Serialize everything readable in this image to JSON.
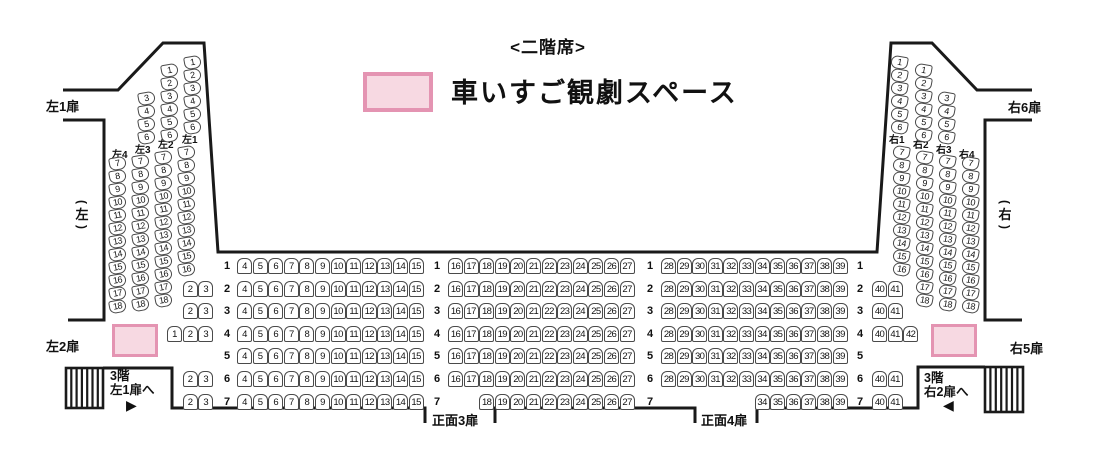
{
  "title": "<二階席>",
  "legend": {
    "label": "車いすご観劇スペース"
  },
  "colors": {
    "wheelchair_fill": "#f7d9e2",
    "wheelchair_border": "#e494b2",
    "wall": "#1a1a1a",
    "seat_border": "#4a4a4a"
  },
  "labels": {
    "door_left1": "左1扉",
    "door_left2": "左2扉",
    "door_right6": "右6扉",
    "door_right5": "右5扉",
    "door_front3": "正面3扉",
    "door_front4": "正面4扉",
    "side_left": "(左)",
    "side_right": "(右)"
  },
  "stairs": {
    "left": {
      "line1": "3階",
      "line2": "左1扉へ",
      "arrow": "▶"
    },
    "right": {
      "line1": "3階",
      "line2": "右2扉へ",
      "arrow": "◀"
    }
  },
  "wheelchair_spaces": [
    {
      "location": "left"
    },
    {
      "location": "right"
    }
  ],
  "left_columns": [
    {
      "label": "左4",
      "top_seats": [],
      "bottom_seats": [
        7,
        8,
        9,
        10,
        11,
        12,
        13,
        14,
        15,
        16,
        17,
        18
      ]
    },
    {
      "label": "左3",
      "top_seats": [
        3,
        4,
        5,
        6
      ],
      "bottom_seats": [
        7,
        8,
        9,
        10,
        11,
        12,
        13,
        14,
        15,
        16,
        17,
        18
      ]
    },
    {
      "label": "左2",
      "top_seats": [
        1,
        2,
        3,
        4,
        5,
        6
      ],
      "bottom_seats": [
        7,
        8,
        9,
        10,
        11,
        12,
        13,
        14,
        15,
        16,
        17,
        18
      ]
    },
    {
      "label": "左1",
      "top_seats": [
        1,
        2,
        3,
        4,
        5,
        6
      ],
      "bottom_seats": [
        7,
        8,
        9,
        10,
        11,
        12,
        13,
        14,
        15,
        16
      ]
    }
  ],
  "right_columns": [
    {
      "label": "右1",
      "top_seats": [
        1,
        2,
        3,
        4,
        5,
        6
      ],
      "bottom_seats": [
        7,
        8,
        9,
        10,
        11,
        12,
        13,
        14,
        15,
        16
      ]
    },
    {
      "label": "右2",
      "top_seats": [
        1,
        2,
        3,
        4,
        5,
        6
      ],
      "bottom_seats": [
        7,
        8,
        9,
        10,
        11,
        12,
        13,
        14,
        15,
        16,
        17,
        18
      ]
    },
    {
      "label": "右3",
      "top_seats": [
        3,
        4,
        5,
        6
      ],
      "bottom_seats": [
        7,
        8,
        9,
        10,
        11,
        12,
        13,
        14,
        15,
        16,
        17,
        18
      ]
    },
    {
      "label": "右4",
      "top_seats": [],
      "bottom_seats": [
        7,
        8,
        9,
        10,
        11,
        12,
        13,
        14,
        15,
        16,
        17,
        18
      ]
    }
  ],
  "center_rows": [
    {
      "row": "1",
      "left_small": [],
      "block_a": [
        4,
        5,
        6,
        7,
        8,
        9,
        10,
        11,
        12,
        13,
        14,
        15
      ],
      "block_b": [
        16,
        17,
        18,
        19,
        20,
        21,
        22,
        23,
        24,
        25,
        26,
        27
      ],
      "block_c": [
        28,
        29,
        30,
        31,
        32,
        33,
        34,
        35,
        36,
        37,
        38,
        39
      ],
      "right_small": []
    },
    {
      "row": "2",
      "left_small": [
        2,
        3
      ],
      "block_a": [
        4,
        5,
        6,
        7,
        8,
        9,
        10,
        11,
        12,
        13,
        14,
        15
      ],
      "block_b": [
        16,
        17,
        18,
        19,
        20,
        21,
        22,
        23,
        24,
        25,
        26,
        27
      ],
      "block_c": [
        28,
        29,
        30,
        31,
        32,
        33,
        34,
        35,
        36,
        37,
        38,
        39
      ],
      "right_small": [
        40,
        41
      ]
    },
    {
      "row": "3",
      "left_small": [
        2,
        3
      ],
      "block_a": [
        4,
        5,
        6,
        7,
        8,
        9,
        10,
        11,
        12,
        13,
        14,
        15
      ],
      "block_b": [
        16,
        17,
        18,
        19,
        20,
        21,
        22,
        23,
        24,
        25,
        26,
        27
      ],
      "block_c": [
        28,
        29,
        30,
        31,
        32,
        33,
        34,
        35,
        36,
        37,
        38,
        39
      ],
      "right_small": [
        40,
        41
      ]
    },
    {
      "row": "4",
      "left_small": [
        1,
        2,
        3
      ],
      "block_a": [
        4,
        5,
        6,
        7,
        8,
        9,
        10,
        11,
        12,
        13,
        14,
        15
      ],
      "block_b": [
        16,
        17,
        18,
        19,
        20,
        21,
        22,
        23,
        24,
        25,
        26,
        27
      ],
      "block_c": [
        28,
        29,
        30,
        31,
        32,
        33,
        34,
        35,
        36,
        37,
        38,
        39
      ],
      "right_small": [
        40,
        41,
        42
      ]
    },
    {
      "row": "5",
      "left_small": [],
      "block_a": [
        4,
        5,
        6,
        7,
        8,
        9,
        10,
        11,
        12,
        13,
        14,
        15
      ],
      "block_b": [
        16,
        17,
        18,
        19,
        20,
        21,
        22,
        23,
        24,
        25,
        26,
        27
      ],
      "block_c": [
        28,
        29,
        30,
        31,
        32,
        33,
        34,
        35,
        36,
        37,
        38,
        39
      ],
      "right_small": []
    },
    {
      "row": "6",
      "left_small": [
        2,
        3
      ],
      "block_a": [
        4,
        5,
        6,
        7,
        8,
        9,
        10,
        11,
        12,
        13,
        14,
        15
      ],
      "block_b": [
        16,
        17,
        18,
        19,
        20,
        21,
        22,
        23,
        24,
        25,
        26,
        27
      ],
      "block_c": [
        28,
        29,
        30,
        31,
        32,
        33,
        34,
        35,
        36,
        37,
        38,
        39
      ],
      "right_small": [
        40,
        41
      ]
    },
    {
      "row": "7",
      "left_small": [
        2,
        3
      ],
      "block_a": [
        4,
        5,
        6,
        7,
        8,
        9,
        10,
        11,
        12,
        13,
        14,
        15
      ],
      "block_b": [
        18,
        19,
        20,
        21,
        22,
        23,
        24,
        25,
        26,
        27
      ],
      "block_c": [
        34,
        35,
        36,
        37,
        38,
        39
      ],
      "right_small": [
        40,
        41
      ]
    }
  ]
}
